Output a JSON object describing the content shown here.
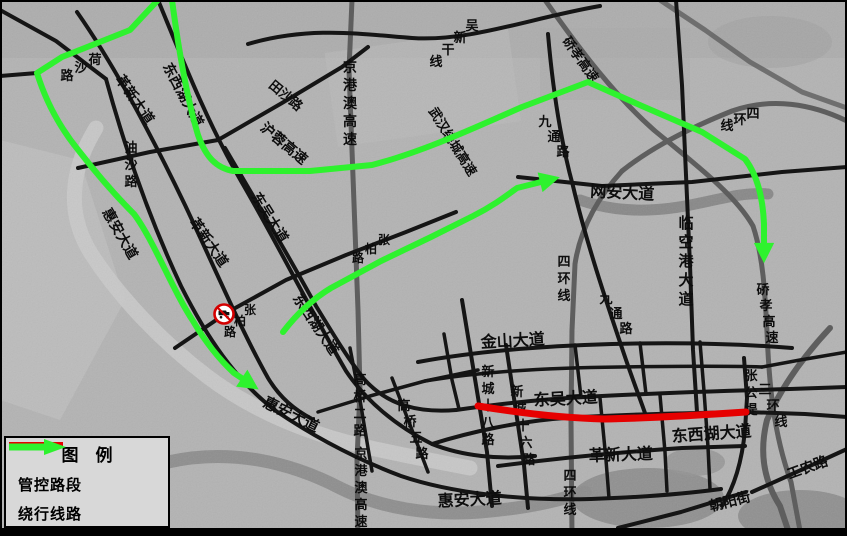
{
  "legend": {
    "title": "图　例",
    "items": [
      {
        "swatch": "red-line",
        "label": "管控路段"
      },
      {
        "swatch": "green-arrow",
        "label": "绕行线路"
      }
    ]
  },
  "colors": {
    "restricted_segment": "#e60000",
    "detour_route": "#2ef22e",
    "road": "#151515",
    "expressway": "#5e5e5e",
    "water": "#8c8c8c",
    "background": "#b3b3b3",
    "legend_bg": "#d8d8d8",
    "sign_red": "#d40000"
  },
  "map": {
    "sign": {
      "type": "no-trucks-prohibition-sign",
      "x": 224,
      "y": 314
    },
    "road_labels": [
      {
        "text": "荷沙路",
        "mode": "d",
        "x": 95,
        "y": 64,
        "sx": -14,
        "sy": 8,
        "size": 13
      },
      {
        "text": "革新大道",
        "mode": "h",
        "x": 131,
        "y": 102,
        "rot": 55,
        "size": 14
      },
      {
        "text": "东西湖大道",
        "mode": "h",
        "x": 179,
        "y": 97,
        "rot": 62,
        "size": 14
      },
      {
        "text": "油沙路",
        "mode": "v",
        "x": 131,
        "y": 152,
        "size": 13
      },
      {
        "text": "田沙路",
        "mode": "h",
        "x": 283,
        "y": 99,
        "rot": 40,
        "size": 13
      },
      {
        "text": "沪蓉高速",
        "mode": "h",
        "x": 281,
        "y": 147,
        "rot": 40,
        "size": 14
      },
      {
        "text": "京港澳高速",
        "mode": "v",
        "x": 350,
        "y": 72,
        "size": 14
      },
      {
        "text": "吴新干线",
        "mode": "d",
        "x": 472,
        "y": 30,
        "sx": -12,
        "sy": 12,
        "size": 13
      },
      {
        "text": "硚孝高速",
        "mode": "h",
        "x": 577,
        "y": 62,
        "rot": 55,
        "size": 13
      },
      {
        "text": "武汉绕城高速",
        "mode": "h",
        "x": 449,
        "y": 144,
        "rot": 58,
        "size": 13
      },
      {
        "text": "九通路",
        "mode": "d",
        "x": 545,
        "y": 126,
        "sx": 9,
        "sy": 15,
        "size": 13
      },
      {
        "text": "四环线",
        "mode": "d",
        "x": 753,
        "y": 118,
        "sx": -13,
        "sy": 6,
        "size": 13
      },
      {
        "text": "网安大道",
        "mode": "h",
        "x": 622,
        "y": 198,
        "rot": 3,
        "size": 16
      },
      {
        "text": "临空港大道",
        "mode": "v",
        "x": 686,
        "y": 228,
        "size": 15
      },
      {
        "text": "四环线",
        "mode": "v",
        "x": 564,
        "y": 266,
        "size": 13
      },
      {
        "text": "九通路",
        "mode": "d",
        "x": 606,
        "y": 303,
        "sx": 10,
        "sy": 15,
        "size": 13
      },
      {
        "text": "硚孝高速",
        "mode": "d",
        "x": 763,
        "y": 294,
        "sx": 3,
        "sy": 16,
        "size": 13
      },
      {
        "text": "金山大道",
        "mode": "h",
        "x": 513,
        "y": 346,
        "rot": -3,
        "size": 16
      },
      {
        "text": "东吴大道",
        "mode": "h",
        "x": 266,
        "y": 220,
        "rot": 58,
        "size": 14
      },
      {
        "text": "东吴大道",
        "mode": "h",
        "x": 566,
        "y": 404,
        "rot": -3,
        "size": 16
      },
      {
        "text": "革新大道",
        "mode": "h",
        "x": 205,
        "y": 245,
        "rot": 55,
        "size": 14
      },
      {
        "text": "张柏路",
        "mode": "d",
        "x": 250,
        "y": 314,
        "sx": -10,
        "sy": 11,
        "size": 12
      },
      {
        "text": "张柏路",
        "mode": "d",
        "x": 384,
        "y": 244,
        "sx": -13,
        "sy": 9,
        "size": 12
      },
      {
        "text": "东西湖大道",
        "mode": "h",
        "x": 312,
        "y": 327,
        "rot": 56,
        "size": 14
      },
      {
        "text": "惠安大道",
        "mode": "h",
        "x": 116,
        "y": 236,
        "rot": 60,
        "size": 14
      },
      {
        "text": "惠安大道",
        "mode": "h",
        "x": 289,
        "y": 419,
        "rot": 26,
        "size": 15
      },
      {
        "text": "惠安大道",
        "mode": "h",
        "x": 470,
        "y": 505,
        "rot": -3,
        "size": 16
      },
      {
        "text": "高桥二路",
        "mode": "v",
        "x": 360,
        "y": 384,
        "size": 13
      },
      {
        "text": "高桥五路",
        "mode": "d",
        "x": 404,
        "y": 410,
        "sx": 6,
        "sy": 16,
        "size": 13
      },
      {
        "text": "京港澳高速",
        "mode": "v",
        "x": 361,
        "y": 458,
        "size": 13
      },
      {
        "text": "新城十八路",
        "mode": "v",
        "x": 488,
        "y": 376,
        "size": 13
      },
      {
        "text": "新城十六路",
        "mode": "d",
        "x": 517,
        "y": 396,
        "sx": 3,
        "sy": 17,
        "size": 13
      },
      {
        "text": "革新大道",
        "mode": "h",
        "x": 621,
        "y": 460,
        "rot": -2,
        "size": 16
      },
      {
        "text": "东西湖大道",
        "mode": "h",
        "x": 712,
        "y": 439,
        "rot": -4,
        "size": 16
      },
      {
        "text": "张公堤",
        "mode": "v",
        "x": 751,
        "y": 380,
        "size": 13
      },
      {
        "text": "三环线",
        "mode": "d",
        "x": 765,
        "y": 394,
        "sx": 8,
        "sy": 16,
        "size": 13
      },
      {
        "text": "四环线",
        "mode": "v",
        "x": 570,
        "y": 480,
        "size": 13
      },
      {
        "text": "工农路",
        "mode": "h",
        "x": 809,
        "y": 472,
        "rot": -20,
        "size": 14
      },
      {
        "text": "朝阳街",
        "mode": "h",
        "x": 731,
        "y": 506,
        "rot": -14,
        "size": 14
      }
    ]
  }
}
